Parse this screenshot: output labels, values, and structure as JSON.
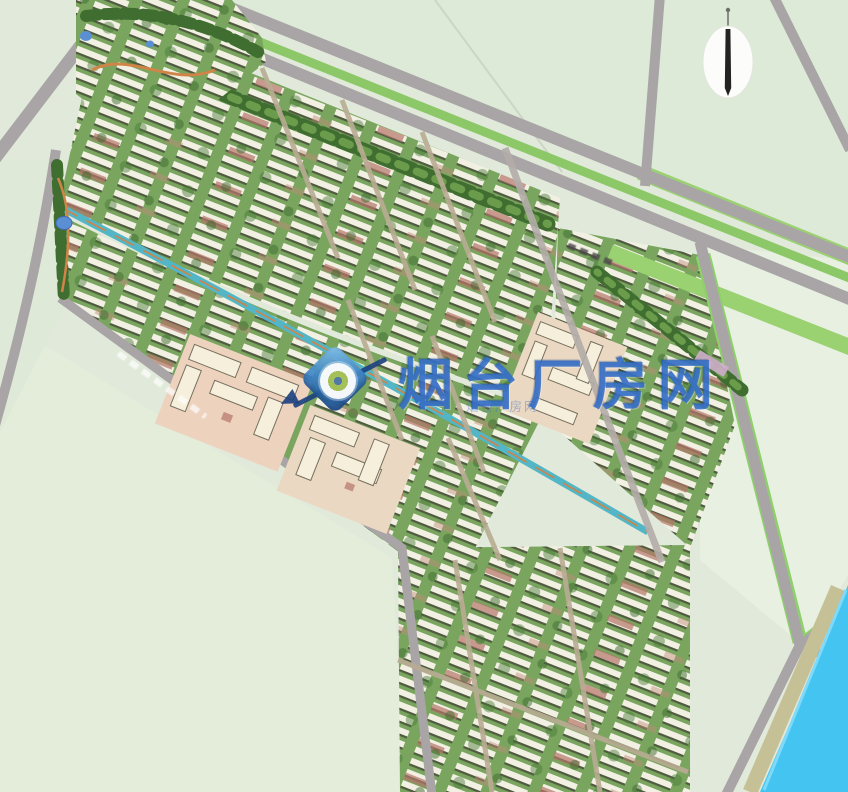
{
  "watermark": {
    "site_name": "烟台厂房网",
    "sub_text": "烟台厂房网",
    "logo": "magnifier-diamond-icon",
    "color": "#2b68c6"
  },
  "compass": {
    "icon": "north-needle-compass"
  },
  "palette": {
    "field": "#e1eada",
    "field_light": "#e7f0e1",
    "road": "#a9a5a7",
    "road_median_green": "#8cc868",
    "road_verge_green": "#9ad171",
    "tree_dark": "#3f6e30",
    "tree_light": "#6b9c4b",
    "housing_lawn": "#79a55e",
    "building_white": "#f1f0e2",
    "building_shadow": "#505a40",
    "building_red_roof": "#b5756a",
    "tan_ground": "#edd2be",
    "cream_building": "#f6efdc",
    "canal_teal": "#53b6c6",
    "path_orange": "#d08448",
    "river_blue": "#44c4f1",
    "shore_olive": "#c6c096",
    "pond_blue": "#5b8fd4",
    "compass_white": "#fcfdfb"
  }
}
